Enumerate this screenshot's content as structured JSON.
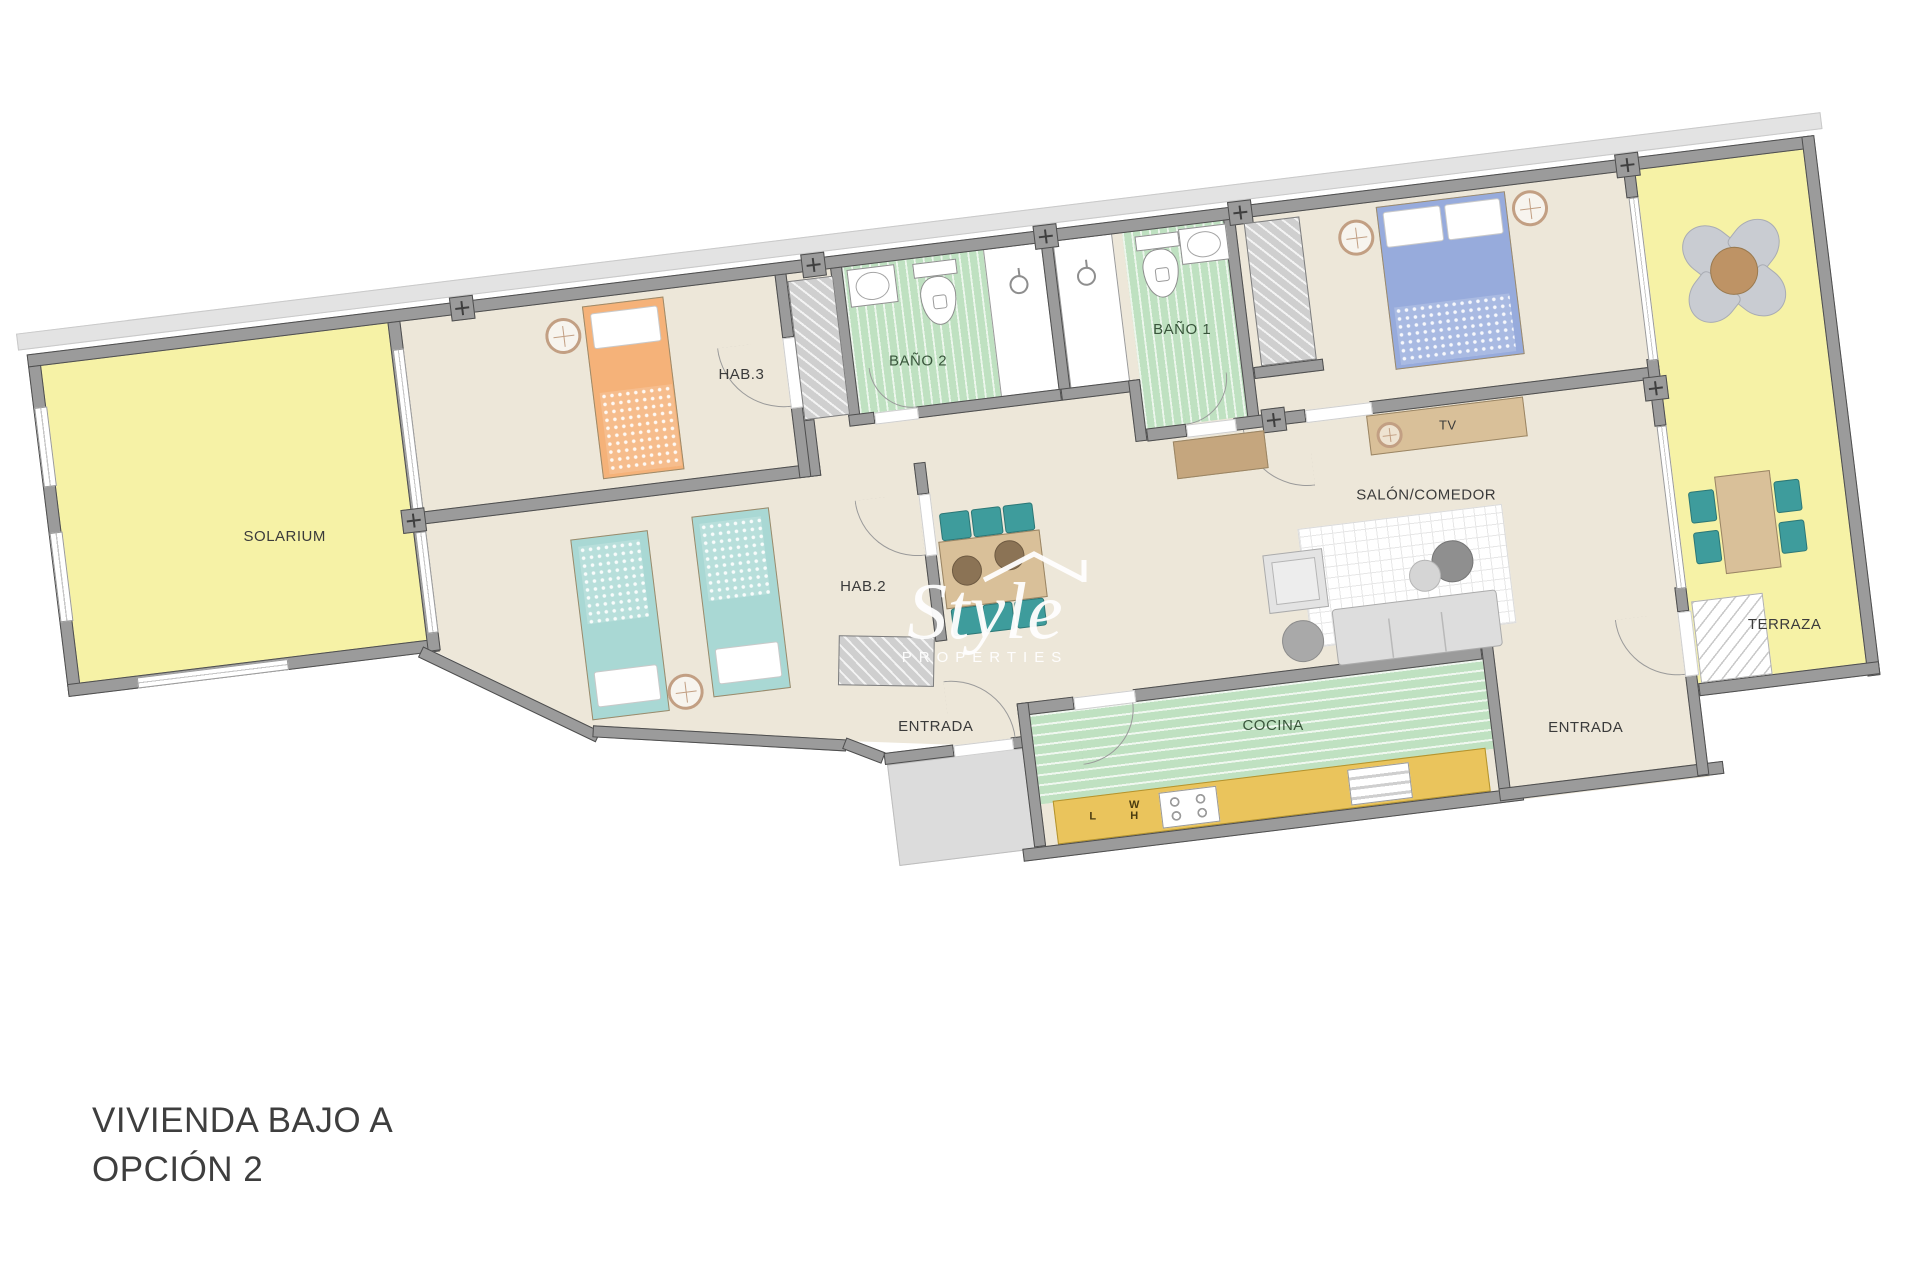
{
  "title": {
    "line1": "VIVIENDA BAJO A",
    "line2": "OPCIÓN 2"
  },
  "watermark": {
    "brand": "Style",
    "subtitle": "PROPERTIES"
  },
  "labels": {
    "solarium": "SOLARIUM",
    "hab3": "HAB.3",
    "bano2": "BAÑO 2",
    "bano1": "BAÑO 1",
    "hab2": "HAB.2",
    "salon": "SALÓN/COMEDOR",
    "tv": "TV",
    "entrada": "ENTRADA",
    "cocina": "COCINA",
    "terraza": "TERRAZA"
  },
  "kitchen_appliances": {
    "l": "L",
    "w": "W",
    "h": "H"
  },
  "colors": {
    "wall": "#9B9B9B",
    "wall_outline": "#4E4E4E",
    "floor_beige": "#EDE7D9",
    "outdoor_yellow": "#F6F2A6",
    "bath_green": "#BFE1C1",
    "counter_yellow": "#EAC45C",
    "bed_orange": "#F5B279",
    "bed_teal": "#A9D8D4",
    "bed_blue": "#97ABDC",
    "chair_teal": "#3E9C9C",
    "furniture_tan": "#D9C099",
    "sideboard_brown": "#C5A67E",
    "lamp_ring": "#C29F83",
    "label_dark": "#3B3B3B",
    "label_green": "#39553B"
  }
}
